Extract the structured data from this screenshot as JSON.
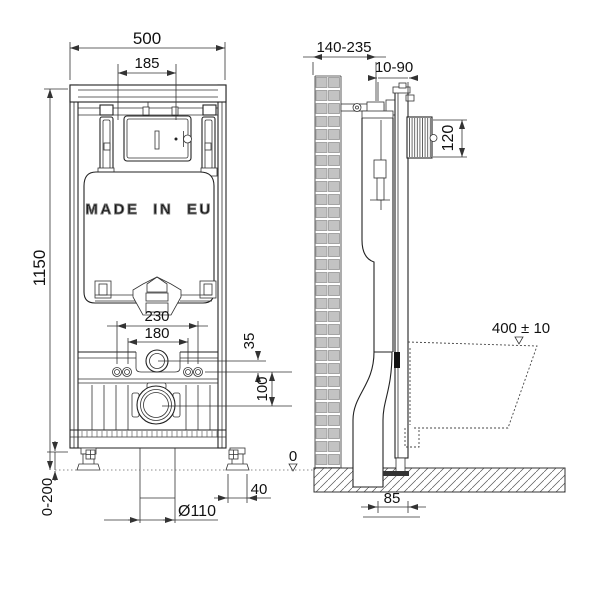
{
  "labels": {
    "front": {
      "overall_width": "500",
      "plate_cutout_width": "185",
      "overall_height": "1150",
      "leg_adjust_range": "0-200",
      "bolt_spacing_outer": "230",
      "bolt_spacing_inner": "180",
      "flush_to_bolts": "35",
      "bolts_to_drain": "100",
      "foot_width": "40",
      "drain_diameter": "Ø110",
      "made_in": "MADE IN EU"
    },
    "side": {
      "depth_range": "140-235",
      "finished_wall_range": "10-90",
      "plate_cutout_height": "120",
      "bowl_rim_height": "400 ± 10",
      "drain_axis_offset": "85"
    },
    "datum": {
      "floor_level": "0"
    }
  },
  "colors": {
    "ink": "#222222",
    "dimension": "#333333",
    "brick_fill": "#c3c3c3",
    "brick_edge": "#8a8a8a",
    "background": "#ffffff"
  }
}
